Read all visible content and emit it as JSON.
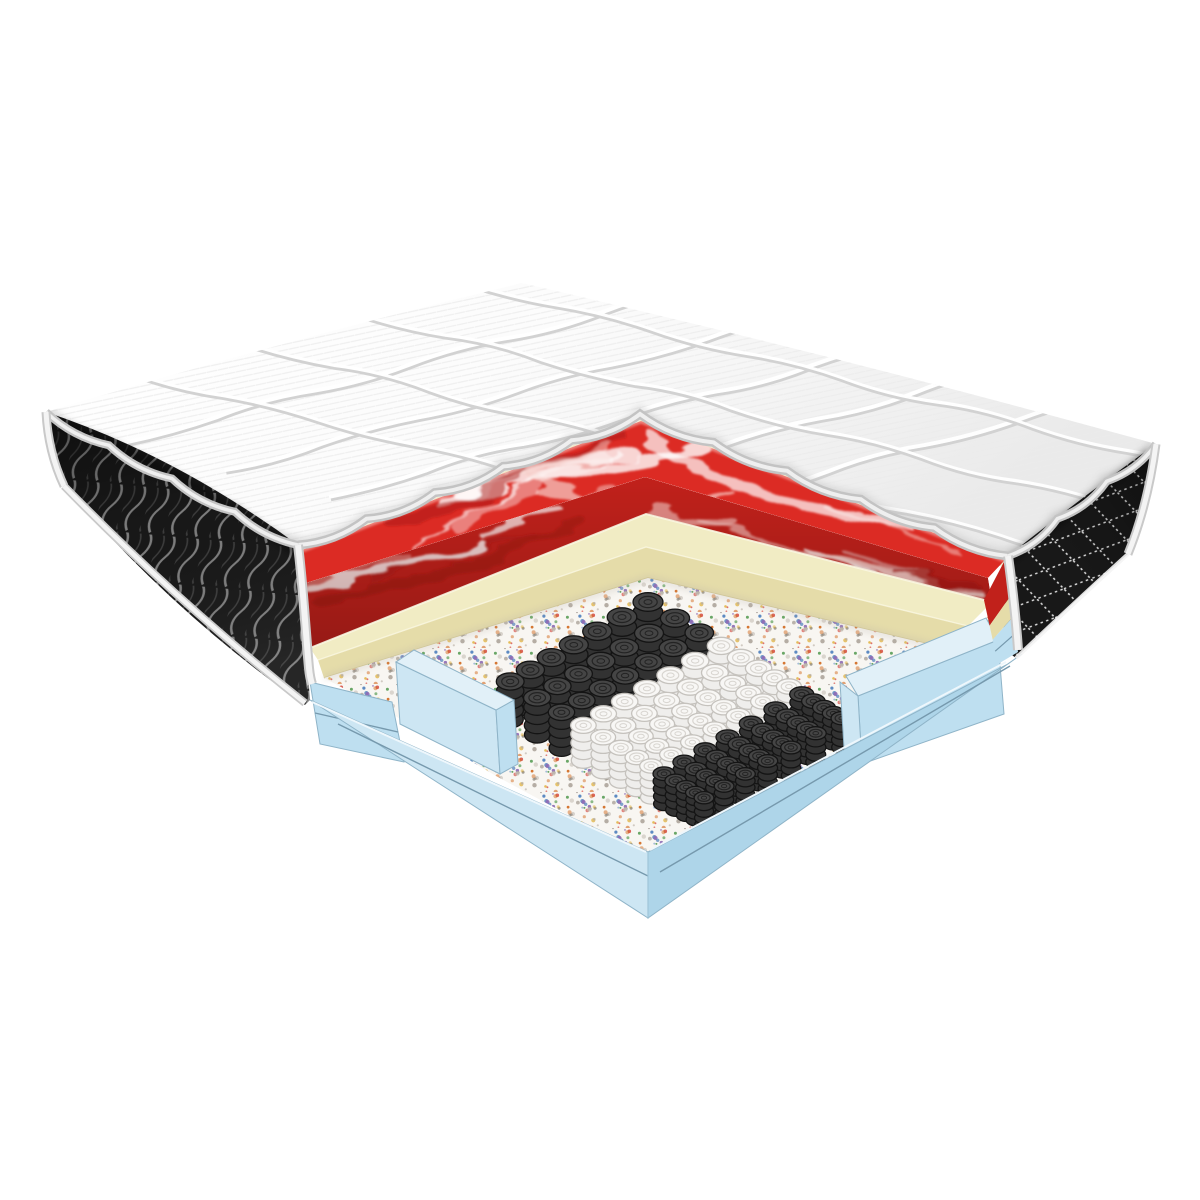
{
  "illustration": {
    "alt": "Mattress cross-section cutaway showing internal layers",
    "background": "#ffffff"
  },
  "colors": {
    "background": "#ffffff",
    "quilt": {
      "base": "#fcfcfc",
      "hatch": "#ebebeb",
      "seam": "#d2d2d2",
      "seamHighlight": "#ffffff",
      "piping": "#c3c3c3",
      "pipingLight": "#efefef",
      "backing": "#efe8c8",
      "edgeShade": "#bdbdbd"
    },
    "sideFabric": {
      "base": "#181818",
      "weaveLight": "#7d7d7d",
      "weaveDark": "#3c3c3c",
      "stitch": "#dcdcdc"
    },
    "piping": {
      "white": "#f4f4f4",
      "grayEdge": "#c9c9c9"
    },
    "redFoam": {
      "top": "#dc2b24",
      "face": "#c1211b",
      "swirlWhite": "#ffffff",
      "swirlPink": "#f6cfc9",
      "swirlDark": "#a81713",
      "sheen": "#ffd9d3",
      "bottomEdge": "#8f120e"
    },
    "creamFoam": {
      "top": "#f1ecc4",
      "face": "#e5dca9",
      "edge": "#faf7e2",
      "shadow": "#cfc48f"
    },
    "felt": {
      "base": "#f8f6f2",
      "flecks": [
        "#c7bfb6",
        "#aaa29a",
        "#b5ada4",
        "#d8544b",
        "#4d7fbd",
        "#dfae35",
        "#5a9e57",
        "#d2691e",
        "#8e6bb5",
        "#8a8378"
      ]
    },
    "blueFoam": {
      "top": "#e1f0f8",
      "light": "#cde6f3",
      "mid": "#bedff0",
      "deep": "#aed5e9",
      "seam": "#7699ad",
      "edge": "#8fb4c8",
      "highlight": "#eef7fc"
    },
    "springWhite": {
      "body": "#efeeec",
      "stroke": "#c5c2bd",
      "top": "#f8f7f5",
      "ring": "#d8d5d0"
    },
    "springDark": {
      "body": "#323232",
      "stroke": "#141414",
      "top": "#454545",
      "ring": "#232323"
    }
  },
  "springs": {
    "dark_rows_left": 3,
    "white_rows": 5,
    "dark_rows_right": 5,
    "depth_columns": 7
  },
  "layers": [
    {
      "id": "quilted-top-cover"
    },
    {
      "id": "black-side-fabric-left"
    },
    {
      "id": "black-side-fabric-right"
    },
    {
      "id": "red-swirl-foam-layer"
    },
    {
      "id": "cream-foam-layer"
    },
    {
      "id": "speckled-felt-pad"
    },
    {
      "id": "pocket-spring-unit"
    },
    {
      "id": "blue-foam-encasement"
    },
    {
      "id": "blue-foam-base"
    }
  ]
}
